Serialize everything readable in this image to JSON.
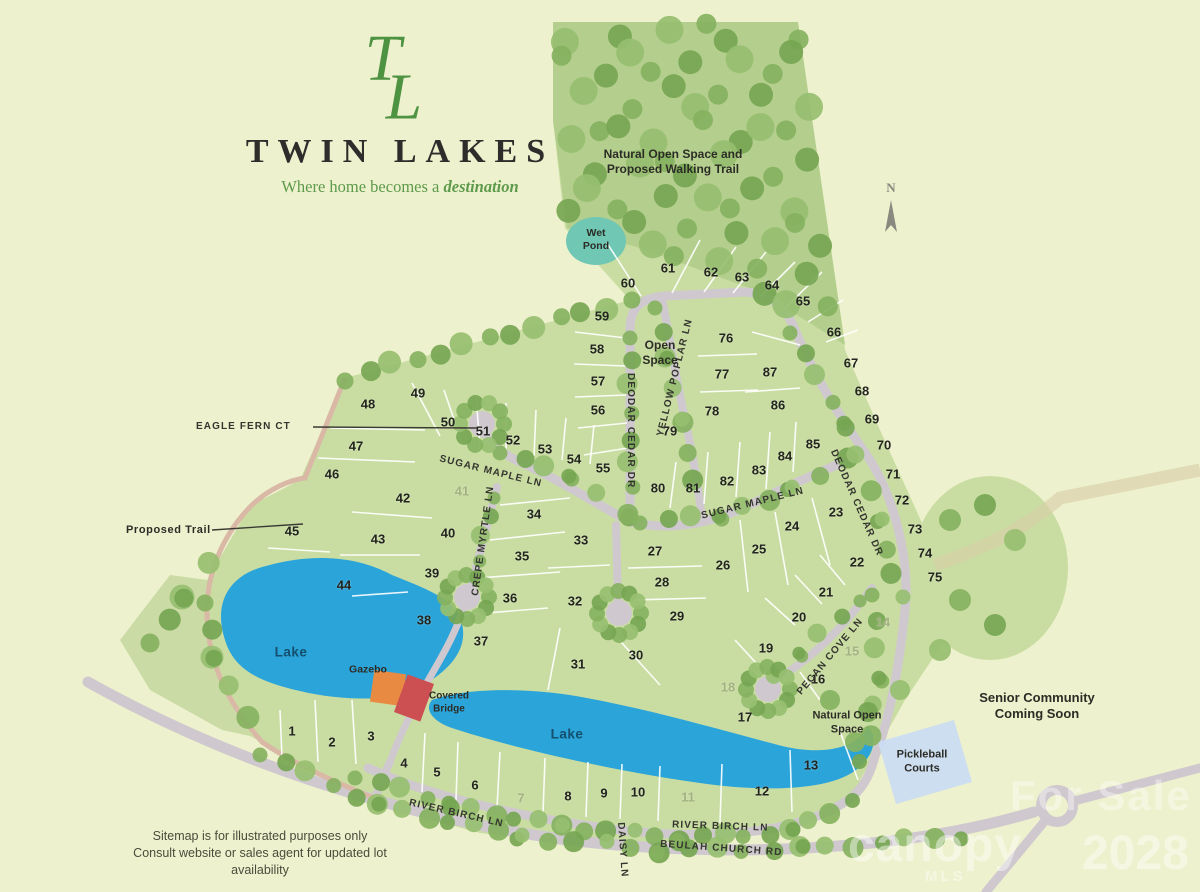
{
  "branding": {
    "monogram": "TL",
    "title": "TWIN LAKES",
    "tagline_prefix": "Where home becomes a ",
    "tagline_emphasis": "destination"
  },
  "map": {
    "north_label": "N",
    "streets": {
      "eagle_fern": "EAGLE FERN CT",
      "sugar_maple": "SUGAR MAPLE LN",
      "deodar_cedar": "DEODAR CEDAR DR",
      "yellow_poplar": "YELLOW POPLAR LN",
      "crepe_myrtle": "CREPE MYRTLE LN",
      "pecan_cove": "PECAN COVE LN",
      "river_birch": "RIVER BIRCH LN",
      "daisy": "DAISY LN",
      "beulah_church": "BEULAH CHURCH RD"
    },
    "poi": {
      "proposed_trail": "Proposed Trail",
      "wet_pond": "Wet Pond",
      "open_space": "Open Space",
      "natural_open_space_trail": "Natural Open Space and Proposed Walking Trail",
      "natural_open_space": "Natural Open Space",
      "senior_community": "Senior Community Coming Soon",
      "pickleball": "Pickleball Courts",
      "lake": "Lake",
      "gazebo": "Gazebo",
      "covered_bridge": "Covered Bridge"
    },
    "lots": [
      {
        "n": "1",
        "x": 292,
        "y": 731
      },
      {
        "n": "2",
        "x": 332,
        "y": 742
      },
      {
        "n": "3",
        "x": 371,
        "y": 736
      },
      {
        "n": "4",
        "x": 404,
        "y": 763
      },
      {
        "n": "5",
        "x": 437,
        "y": 772
      },
      {
        "n": "6",
        "x": 475,
        "y": 785
      },
      {
        "n": "7",
        "x": 521,
        "y": 798,
        "faded": true
      },
      {
        "n": "8",
        "x": 568,
        "y": 796
      },
      {
        "n": "9",
        "x": 604,
        "y": 793
      },
      {
        "n": "10",
        "x": 638,
        "y": 792
      },
      {
        "n": "11",
        "x": 688,
        "y": 797,
        "faded": true
      },
      {
        "n": "12",
        "x": 762,
        "y": 791
      },
      {
        "n": "13",
        "x": 811,
        "y": 765
      },
      {
        "n": "14",
        "x": 883,
        "y": 622,
        "faded": true
      },
      {
        "n": "15",
        "x": 852,
        "y": 651,
        "faded": true
      },
      {
        "n": "16",
        "x": 818,
        "y": 679
      },
      {
        "n": "17",
        "x": 745,
        "y": 717
      },
      {
        "n": "18",
        "x": 728,
        "y": 687,
        "faded": true
      },
      {
        "n": "19",
        "x": 766,
        "y": 648
      },
      {
        "n": "20",
        "x": 799,
        "y": 617
      },
      {
        "n": "21",
        "x": 826,
        "y": 592
      },
      {
        "n": "22",
        "x": 857,
        "y": 562
      },
      {
        "n": "23",
        "x": 836,
        "y": 512
      },
      {
        "n": "24",
        "x": 792,
        "y": 526
      },
      {
        "n": "25",
        "x": 759,
        "y": 549
      },
      {
        "n": "26",
        "x": 723,
        "y": 565
      },
      {
        "n": "27",
        "x": 655,
        "y": 551
      },
      {
        "n": "28",
        "x": 662,
        "y": 582
      },
      {
        "n": "29",
        "x": 677,
        "y": 616
      },
      {
        "n": "30",
        "x": 636,
        "y": 655
      },
      {
        "n": "31",
        "x": 578,
        "y": 664
      },
      {
        "n": "32",
        "x": 575,
        "y": 601
      },
      {
        "n": "33",
        "x": 581,
        "y": 540
      },
      {
        "n": "34",
        "x": 534,
        "y": 514
      },
      {
        "n": "35",
        "x": 522,
        "y": 556
      },
      {
        "n": "36",
        "x": 510,
        "y": 598
      },
      {
        "n": "37",
        "x": 481,
        "y": 641
      },
      {
        "n": "38",
        "x": 424,
        "y": 620
      },
      {
        "n": "39",
        "x": 432,
        "y": 573
      },
      {
        "n": "40",
        "x": 448,
        "y": 533
      },
      {
        "n": "41",
        "x": 462,
        "y": 491,
        "faded": true
      },
      {
        "n": "42",
        "x": 403,
        "y": 498
      },
      {
        "n": "43",
        "x": 378,
        "y": 539
      },
      {
        "n": "44",
        "x": 344,
        "y": 585
      },
      {
        "n": "45",
        "x": 292,
        "y": 531
      },
      {
        "n": "46",
        "x": 332,
        "y": 474
      },
      {
        "n": "47",
        "x": 356,
        "y": 446
      },
      {
        "n": "48",
        "x": 368,
        "y": 404
      },
      {
        "n": "49",
        "x": 418,
        "y": 393
      },
      {
        "n": "50",
        "x": 448,
        "y": 422
      },
      {
        "n": "51",
        "x": 483,
        "y": 431
      },
      {
        "n": "52",
        "x": 513,
        "y": 440
      },
      {
        "n": "53",
        "x": 545,
        "y": 449
      },
      {
        "n": "54",
        "x": 574,
        "y": 459
      },
      {
        "n": "55",
        "x": 603,
        "y": 468
      },
      {
        "n": "56",
        "x": 598,
        "y": 410
      },
      {
        "n": "57",
        "x": 598,
        "y": 381
      },
      {
        "n": "58",
        "x": 597,
        "y": 349
      },
      {
        "n": "59",
        "x": 602,
        "y": 316
      },
      {
        "n": "60",
        "x": 628,
        "y": 283
      },
      {
        "n": "61",
        "x": 668,
        "y": 268
      },
      {
        "n": "62",
        "x": 711,
        "y": 272
      },
      {
        "n": "63",
        "x": 742,
        "y": 277
      },
      {
        "n": "64",
        "x": 772,
        "y": 285
      },
      {
        "n": "65",
        "x": 803,
        "y": 301
      },
      {
        "n": "66",
        "x": 834,
        "y": 332
      },
      {
        "n": "67",
        "x": 851,
        "y": 363
      },
      {
        "n": "68",
        "x": 862,
        "y": 391
      },
      {
        "n": "69",
        "x": 872,
        "y": 419
      },
      {
        "n": "70",
        "x": 884,
        "y": 445
      },
      {
        "n": "71",
        "x": 893,
        "y": 474
      },
      {
        "n": "72",
        "x": 902,
        "y": 500
      },
      {
        "n": "73",
        "x": 915,
        "y": 529
      },
      {
        "n": "74",
        "x": 925,
        "y": 553
      },
      {
        "n": "75",
        "x": 935,
        "y": 577
      },
      {
        "n": "76",
        "x": 726,
        "y": 338
      },
      {
        "n": "77",
        "x": 722,
        "y": 374
      },
      {
        "n": "78",
        "x": 712,
        "y": 411
      },
      {
        "n": "79",
        "x": 670,
        "y": 431
      },
      {
        "n": "80",
        "x": 658,
        "y": 488
      },
      {
        "n": "81",
        "x": 693,
        "y": 488
      },
      {
        "n": "82",
        "x": 727,
        "y": 481
      },
      {
        "n": "83",
        "x": 759,
        "y": 470
      },
      {
        "n": "84",
        "x": 785,
        "y": 456
      },
      {
        "n": "85",
        "x": 813,
        "y": 444
      },
      {
        "n": "86",
        "x": 778,
        "y": 405
      },
      {
        "n": "87",
        "x": 770,
        "y": 372
      }
    ]
  },
  "footer": {
    "line1": "Sitemap is for illustrated purposes only",
    "line2": "Consult website or sales agent for updated lot availability"
  },
  "watermark": {
    "for_sale": "For Sale",
    "canopy": "canopy",
    "mls": "MLS",
    "year": "2028"
  },
  "colors": {
    "background": "#eef1cd",
    "community_green": "#c9dda2",
    "forest_green": "#b4cf8d",
    "tree_green": "#85b25e",
    "lake_blue": "#2ba4da",
    "wet_pond_teal": "#6fc7b4",
    "road_gray": "#cfc9cf",
    "trail_pink": "#d9b9a6",
    "gazebo_orange": "#e98a43",
    "bridge_red": "#cc4f52",
    "pickleball_blue": "#cadcf2",
    "logo_green": "#4e9342"
  }
}
